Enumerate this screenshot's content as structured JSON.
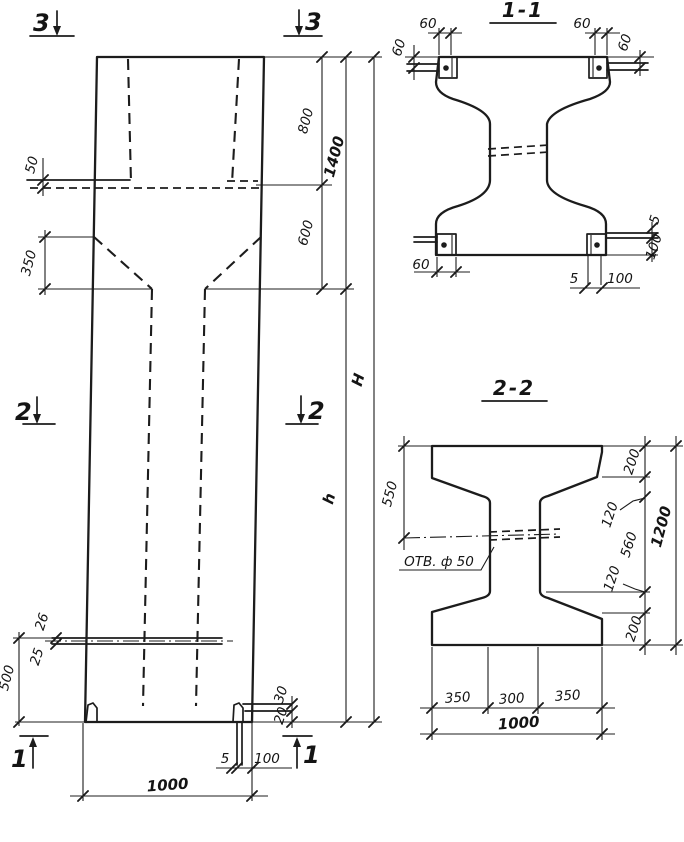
{
  "colors": {
    "ink": "#1c1c1c",
    "paper": "#ffffff"
  },
  "elevation": {
    "section_markers": {
      "top": "3",
      "middle": "2",
      "bottom": "1"
    },
    "dims": {
      "ledge_offset": "50",
      "taper_height": "350",
      "top_part": "800",
      "top_total": "1400",
      "neck": "600",
      "full_height": "Н",
      "shaft_height": "h",
      "base_height": "500",
      "hole_upper": "26",
      "hole_lower": "25",
      "base_plate_30": "30",
      "base_plate_20": "20",
      "anchor_5": "5",
      "anchor_100": "100",
      "width": "1000"
    }
  },
  "section_1_1": {
    "title": "1-1",
    "dims": {
      "top_left_leg": "60",
      "top_right_leg": "60",
      "left_depth": "60",
      "right_depth": "60",
      "bottom_left_leg": "60",
      "bottom_plate_thk": "5",
      "bottom_plate_len": "100",
      "side_plate_thk": "5",
      "side_plate_len": "100"
    }
  },
  "section_2_2": {
    "title": "2-2",
    "hole_label": "ОТВ. ф 50",
    "dims": {
      "flange_to_hole": "550",
      "flange_top": "200",
      "haunch_top": "120",
      "web_straight": "560",
      "haunch_bottom": "120",
      "flange_bottom": "200",
      "overall_height": "1200",
      "left_overhang": "350",
      "web_width": "300",
      "right_overhang": "350",
      "overall_width": "1000"
    }
  }
}
